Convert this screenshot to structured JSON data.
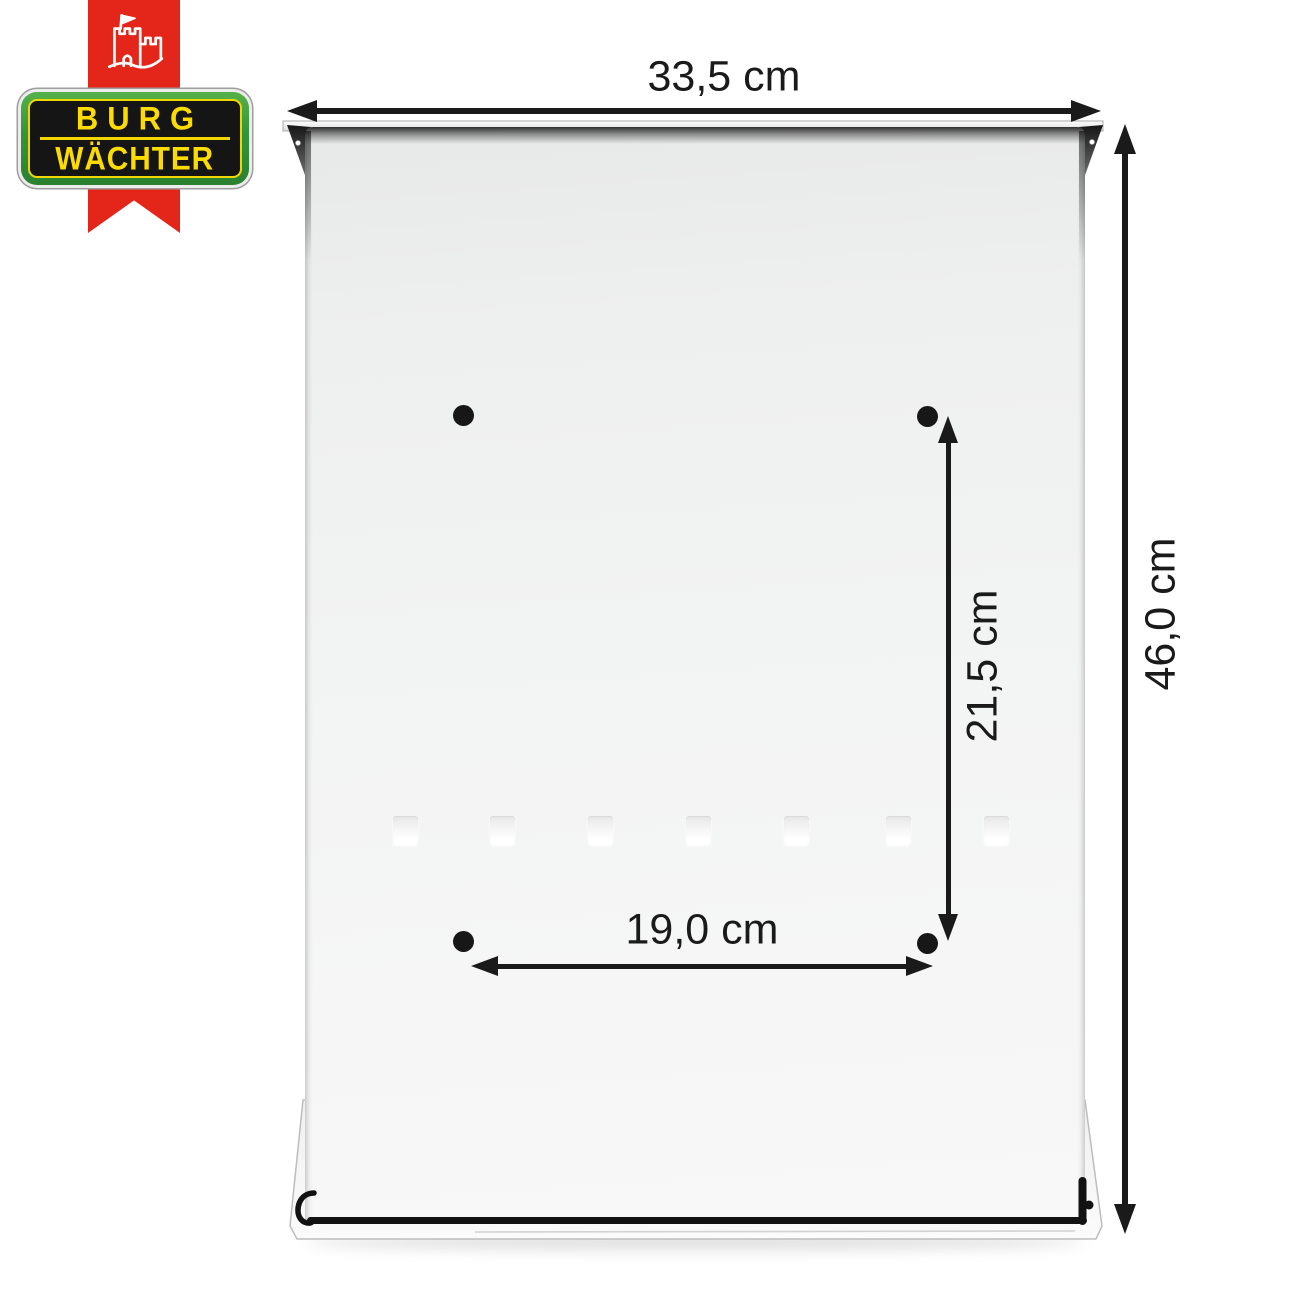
{
  "brand": {
    "line1": "BURG",
    "line2": "WÄCHTER",
    "icon": "castle-flag-icon",
    "colors": {
      "red": "#e32619",
      "green": "#33953a",
      "yellow": "#fcdc00",
      "badge_black": "#151515"
    }
  },
  "diagram": {
    "object": "mailbox-back-panel-with-mounting-holes",
    "annotation_color": "#1a1a1a",
    "dims": {
      "overall_width": "33,5 cm",
      "overall_height": "46,0 cm",
      "hole_spacing_vertical": "21,5 cm",
      "hole_spacing_horizontal": "19,0 cm"
    },
    "mounting_holes_count": 4,
    "embossed_slots_count": 7
  }
}
